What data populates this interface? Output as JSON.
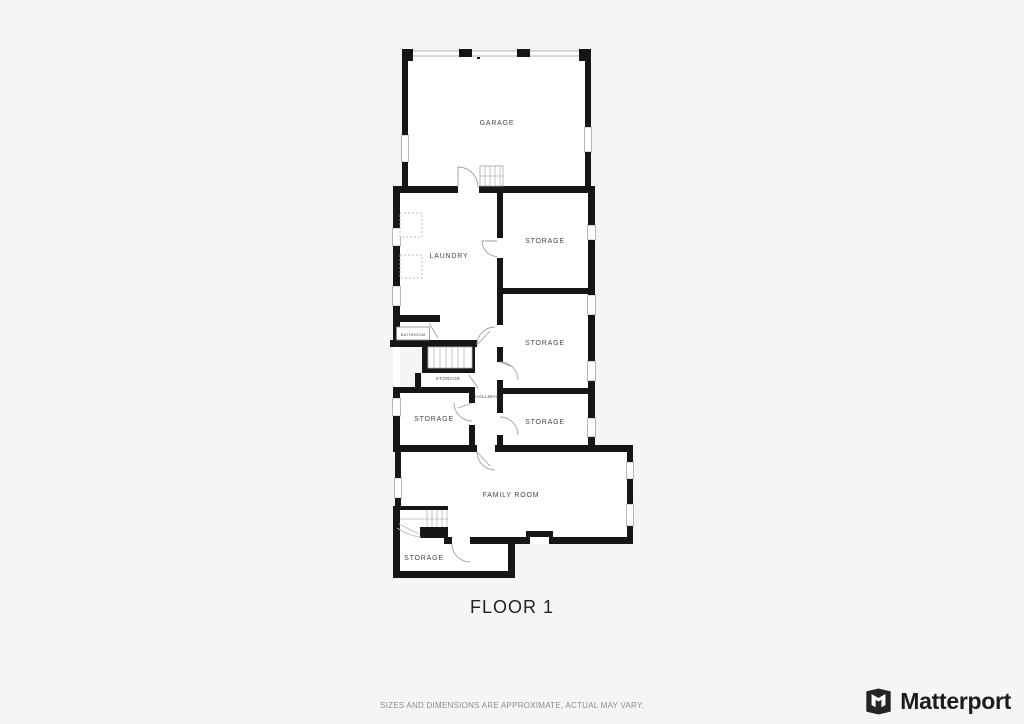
{
  "plan": {
    "title": "FLOOR 1",
    "room_labels": {
      "garage": "GARAGE",
      "laundry": "LAUNDRY",
      "storage_top": "STORAGE",
      "storage_middle": "STORAGE",
      "storage_right_lower": "STORAGE",
      "storage_left": "STORAGE",
      "storage_under_stairs": "STORAGE",
      "hallway": "HALLWAY",
      "bathroom": "BATHROOM",
      "family_room": "FAMILY ROOM",
      "storage_bottom": "STORAGE"
    }
  },
  "footer": {
    "disclaimer": "SIZES AND DIMENSIONS ARE APPROXIMATE, ACTUAL MAY VARY.",
    "brand_name": "Matterport"
  },
  "colors": {
    "background": "#f5f5f4",
    "wall": "#161616",
    "room_fill": "#ffffff",
    "detail_line": "#9f9f9f",
    "label_text": "#474747",
    "disclaimer_text": "#8d8d8d",
    "brand_text": "#1b1b1d"
  }
}
